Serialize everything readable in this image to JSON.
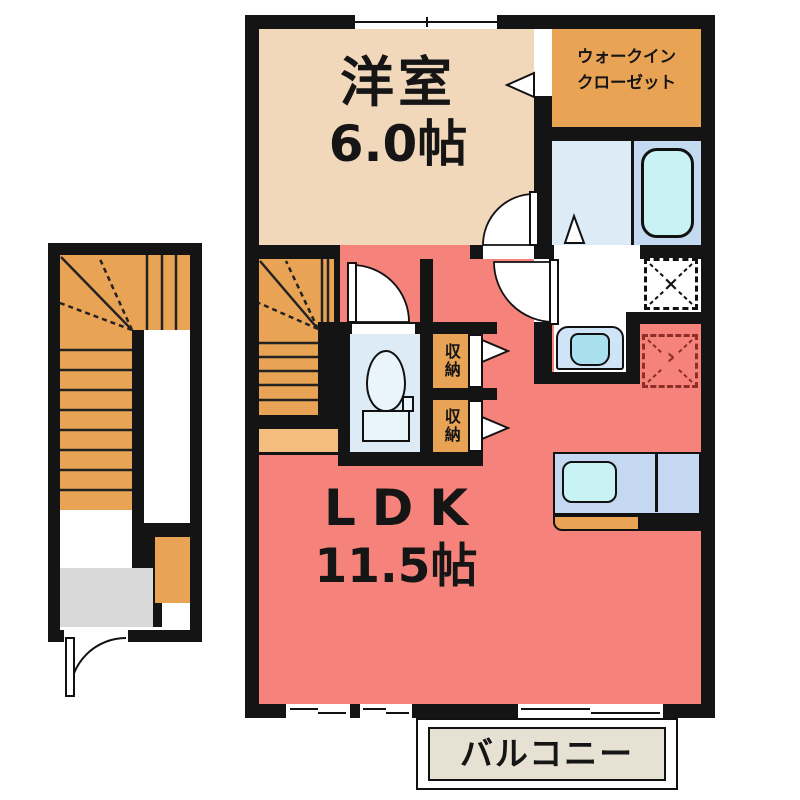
{
  "colors": {
    "wall": "#141414",
    "tan": "#f2d8bb",
    "orange": "#e9a355",
    "orange_light": "#f3bd80",
    "pink": "#f5837b",
    "blue_floor": "#ddebf7",
    "blue_zone": "#c4daf1",
    "cyan": "#c9f2f4",
    "counter_blue": "#c4d8f2",
    "bowl_blue": "#aadff0",
    "fixture_white": "#eaf4fb",
    "gray": "#d9d9d9",
    "balcony_bg": "#e6e1d3",
    "fridge_dash": "#8b2f28"
  },
  "rooms": {
    "western_room": {
      "name": "洋室",
      "size": "6.0帖"
    },
    "walk_in_closet": {
      "line1": "ウォークイン",
      "line2": "クローゼット"
    },
    "ldk": {
      "name": "LDK",
      "size": "11.5帖"
    },
    "balcony": {
      "name": "バルコニー"
    },
    "storage_upper": {
      "name": "収納"
    },
    "storage_lower": {
      "name": "収納"
    }
  },
  "symbols": {
    "washing_machine_mark": "×",
    "refrigerator_mark": "›"
  }
}
